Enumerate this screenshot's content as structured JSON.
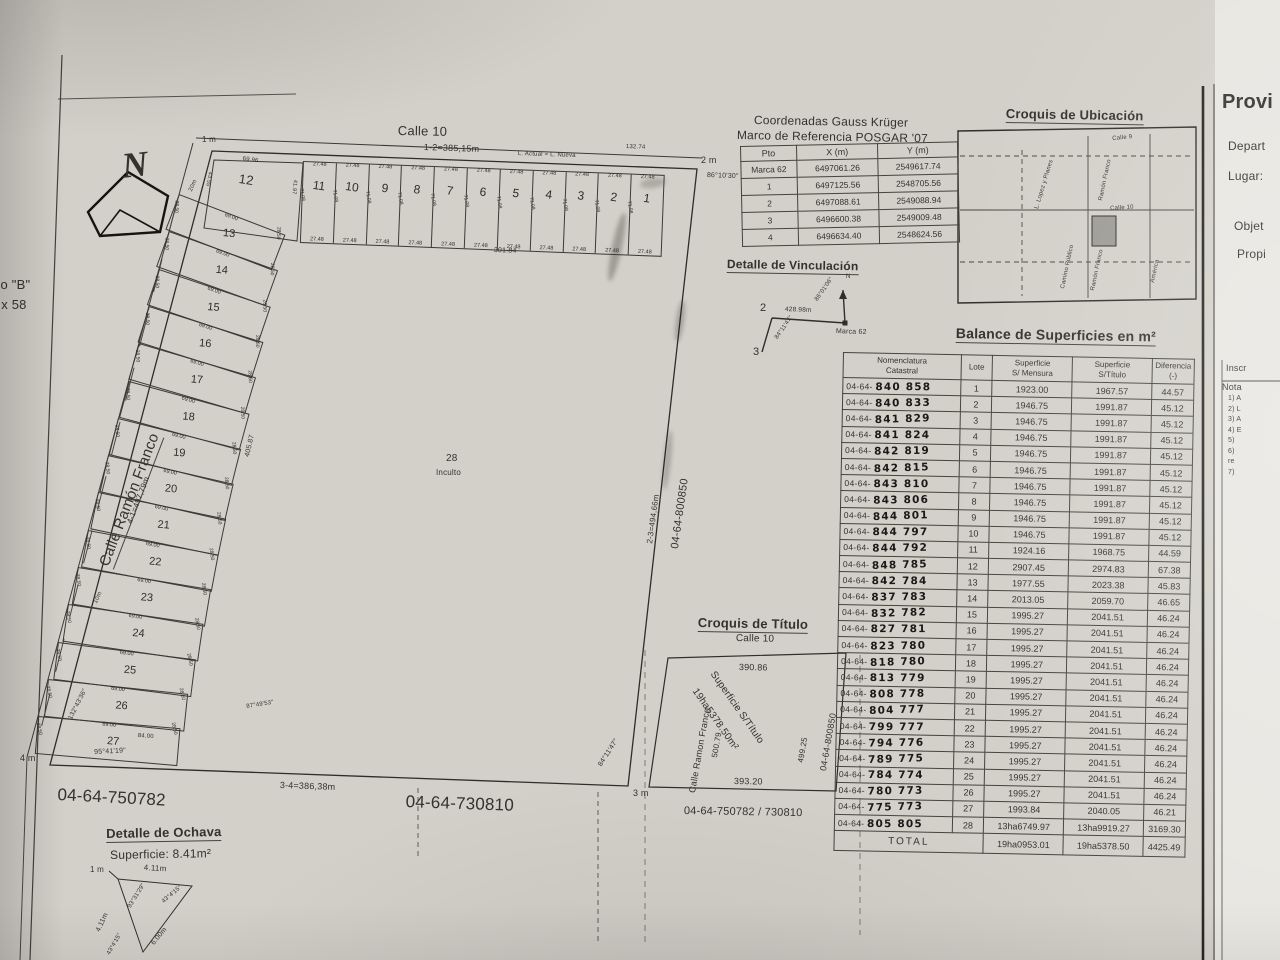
{
  "sheet": {
    "margin_top_left_1": "ipo \"B\"",
    "margin_top_left_2": "2 x 58"
  },
  "compass": {
    "letter": "N"
  },
  "plat": {
    "calle10": "Calle 10",
    "dim_1_2": "1-2=385,15m",
    "note_top": "L. Actual = L. Nueva",
    "dim_right_top": "132.74",
    "corner1": "1 m",
    "corner2": "2 m",
    "corner3": "3 m",
    "corner4": "4 m",
    "angle2": "86°10'30\"",
    "angle3": "84°11'47\"",
    "angle4": "95°41'19\"",
    "angle27": "132°43'36\"",
    "angle27b": "87°49'53\"",
    "street_left": "Calle Ramón Franco",
    "dim_4_1": "4-1=497,79m",
    "dim_2_3": "2-3=494,66m",
    "dim_3_4": "3-4=386,38m",
    "adj_right": "04-64-800850",
    "adj_bottom_left": "04-64-750782",
    "adj_bottom": "04-64-730810",
    "mark_20m": "20m",
    "mark_10m": "10m",
    "back_top": "301.84",
    "back_left": "405.87",
    "lot28": {
      "num": "28",
      "cond": "Inculto"
    },
    "top_lots": {
      "numbers": [
        "11",
        "10",
        "9",
        "8",
        "7",
        "6",
        "5",
        "4",
        "3",
        "2",
        "1"
      ],
      "front": "27.48",
      "depth": "71.08"
    },
    "corner_lot": {
      "number": "12",
      "front": "69.96",
      "left": "43.55",
      "right": "41.97"
    },
    "left_lots": {
      "numbers": [
        "13",
        "14",
        "15",
        "16",
        "17",
        "18",
        "19",
        "20",
        "21",
        "22",
        "23",
        "24",
        "25",
        "26",
        "27"
      ],
      "front": "69.00",
      "side": "28.50",
      "lot27_base": "84.00"
    }
  },
  "coord_table": {
    "title1": "Coordenadas Gauss Krüger",
    "title2": "Marco de Referencia POSGAR '07",
    "headers": [
      "Pto",
      "X (m)",
      "Y (m)"
    ],
    "rows": [
      [
        "Marca 62",
        "6497061.26",
        "2549617.74"
      ],
      [
        "1",
        "6497125.56",
        "2548705.56"
      ],
      [
        "2",
        "6497088.61",
        "2549088.94"
      ],
      [
        "3",
        "6496600.38",
        "2549009.48"
      ],
      [
        "4",
        "6496634.40",
        "2548624.56"
      ]
    ]
  },
  "ubicacion": {
    "title": "Croquis de Ubicación",
    "labels": [
      "Calle 9",
      "L. Lopez y Planes",
      "Ramón Franco",
      "Calle 10",
      "Camino Público",
      "Ramón Franco",
      "América"
    ]
  },
  "vinculacion": {
    "title": "Detalle de Vinculación",
    "p2": "2",
    "p3": "3",
    "dist": "428.98m",
    "marca": "Marca 62",
    "ang_a": "86°01'06\"",
    "ang_b": "84°11'47\"",
    "north": "N"
  },
  "balance": {
    "title": "Balance de Superficies en m²",
    "col_nom_1": "Nomenclatura",
    "col_nom_2": "Catastral",
    "col_lote": "Lote",
    "col_mensura_1": "Superficie",
    "col_mensura_2": "S/ Mensura",
    "col_titulo_1": "Superficie",
    "col_titulo_2": "S/Título",
    "col_dif_1": "Diferencia",
    "col_dif_2": "(-)",
    "prefix": "04-64-",
    "rows": [
      [
        "840 858",
        "1",
        "1923.00",
        "1967.57",
        "44.57"
      ],
      [
        "840 833",
        "2",
        "1946.75",
        "1991.87",
        "45.12"
      ],
      [
        "841 829",
        "3",
        "1946.75",
        "1991.87",
        "45.12"
      ],
      [
        "841 824",
        "4",
        "1946.75",
        "1991.87",
        "45.12"
      ],
      [
        "842 819",
        "5",
        "1946.75",
        "1991.87",
        "45.12"
      ],
      [
        "842 815",
        "6",
        "1946.75",
        "1991.87",
        "45.12"
      ],
      [
        "843 810",
        "7",
        "1946.75",
        "1991.87",
        "45.12"
      ],
      [
        "843 806",
        "8",
        "1946.75",
        "1991.87",
        "45.12"
      ],
      [
        "844 801",
        "9",
        "1946.75",
        "1991.87",
        "45.12"
      ],
      [
        "844 797",
        "10",
        "1946.75",
        "1991.87",
        "45.12"
      ],
      [
        "844 792",
        "11",
        "1924.16",
        "1968.75",
        "44.59"
      ],
      [
        "848 785",
        "12",
        "2907.45",
        "2974.83",
        "67.38"
      ],
      [
        "842 784",
        "13",
        "1977.55",
        "2023.38",
        "45.83"
      ],
      [
        "837 783",
        "14",
        "2013.05",
        "2059.70",
        "46.65"
      ],
      [
        "832 782",
        "15",
        "1995.27",
        "2041.51",
        "46.24"
      ],
      [
        "827 781",
        "16",
        "1995.27",
        "2041.51",
        "46.24"
      ],
      [
        "823 780",
        "17",
        "1995.27",
        "2041.51",
        "46.24"
      ],
      [
        "818 780",
        "18",
        "1995.27",
        "2041.51",
        "46.24"
      ],
      [
        "813 779",
        "19",
        "1995.27",
        "2041.51",
        "46.24"
      ],
      [
        "808 778",
        "20",
        "1995.27",
        "2041.51",
        "46.24"
      ],
      [
        "804 777",
        "21",
        "1995.27",
        "2041.51",
        "46.24"
      ],
      [
        "799 777",
        "22",
        "1995.27",
        "2041.51",
        "46.24"
      ],
      [
        "794 776",
        "23",
        "1995.27",
        "2041.51",
        "46.24"
      ],
      [
        "789 775",
        "24",
        "1995.27",
        "2041.51",
        "46.24"
      ],
      [
        "784 774",
        "25",
        "1995.27",
        "2041.51",
        "46.24"
      ],
      [
        "780 773",
        "26",
        "1995.27",
        "2041.51",
        "46.24"
      ],
      [
        "775 773",
        "27",
        "1993.84",
        "2040.05",
        "46.21"
      ],
      [
        "805 805",
        "28",
        "13ha6749.97",
        "13ha9919.27",
        "3169.30"
      ]
    ],
    "total_label": "TOTAL",
    "total": [
      "19ha0953.01",
      "19ha5378.50",
      "4425.49"
    ]
  },
  "titulo": {
    "title": "Croquis de Título",
    "calle10": "Calle 10",
    "top": "390.86",
    "left_street": "Calle Ramon Franco",
    "left": "500.79",
    "diag1": "Superficie S/Título",
    "diag2": "19ha5378.50m²",
    "right": "499.25",
    "right_outer": "04-64-800850",
    "bottom": "393.20",
    "bottom_outer": "04-64-750782 / 730810"
  },
  "ochava": {
    "title": "Detalle de Ochava",
    "superficie": "Superficie: 8.41m²",
    "corner": "1 m",
    "top": "4.11m",
    "left": "4.11m",
    "hyp": "6.00m",
    "ang_top": "93°31'29\"",
    "ang_right": "43°4'15\"",
    "ang_bottom": "43°4'15\""
  },
  "right_panel": {
    "title": "Provi",
    "f1": "Depart",
    "f2": "Lugar:",
    "f3": "Objet",
    "f4": "Propi",
    "inscr": "Inscr",
    "nota": "Nota",
    "items": [
      "1) A",
      "2) L",
      "3) A",
      "4) E",
      "5)",
      "6)",
      "re",
      "7)"
    ]
  }
}
